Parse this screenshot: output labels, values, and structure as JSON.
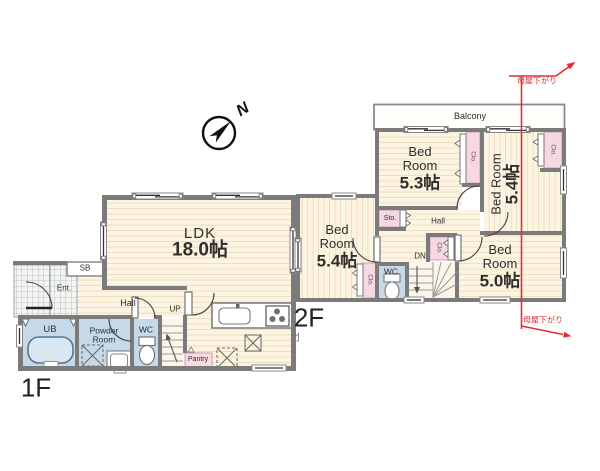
{
  "compass": {
    "north_label": "N"
  },
  "annotations": {
    "roof_note_top": "母屋下がり",
    "roof_note_bottom": "母屋下がり"
  },
  "floor1": {
    "label": "1F",
    "rooms": {
      "ldk": {
        "name": "LDK",
        "size": "18.0帖"
      },
      "hall": "Hall",
      "stairs_up": "UP",
      "shoe_box": "SB",
      "entrance": "Ent.",
      "unit_bath": "UB",
      "powder_line1": "Powder",
      "powder_line2": "Room",
      "wc": "WC",
      "pantry": "Pantry"
    }
  },
  "floor2": {
    "label": "2F",
    "rooms": {
      "balcony": "Balcony",
      "bed1": {
        "name_line1": "Bed",
        "name_line2": "Room",
        "size": "5.3帖"
      },
      "bed2": {
        "name": "Bed Room",
        "size": "5.4帖"
      },
      "bed3": {
        "name_line1": "Bed",
        "name_line2": "Room",
        "size": "5.4帖"
      },
      "bed4": {
        "name_line1": "Bed",
        "name_line2": "Room",
        "size": "5.0帖"
      },
      "hall": "Hall",
      "storage": "Sto.",
      "closet": "Clo.",
      "wc": "WC",
      "stairs_down": "DN"
    }
  },
  "colors": {
    "floor": "#fdf3e1",
    "wet_room": "#c6d9e8",
    "closet": "#f7d8e2",
    "wall": "#7b7b7b",
    "annotation_red": "#e02f35"
  }
}
